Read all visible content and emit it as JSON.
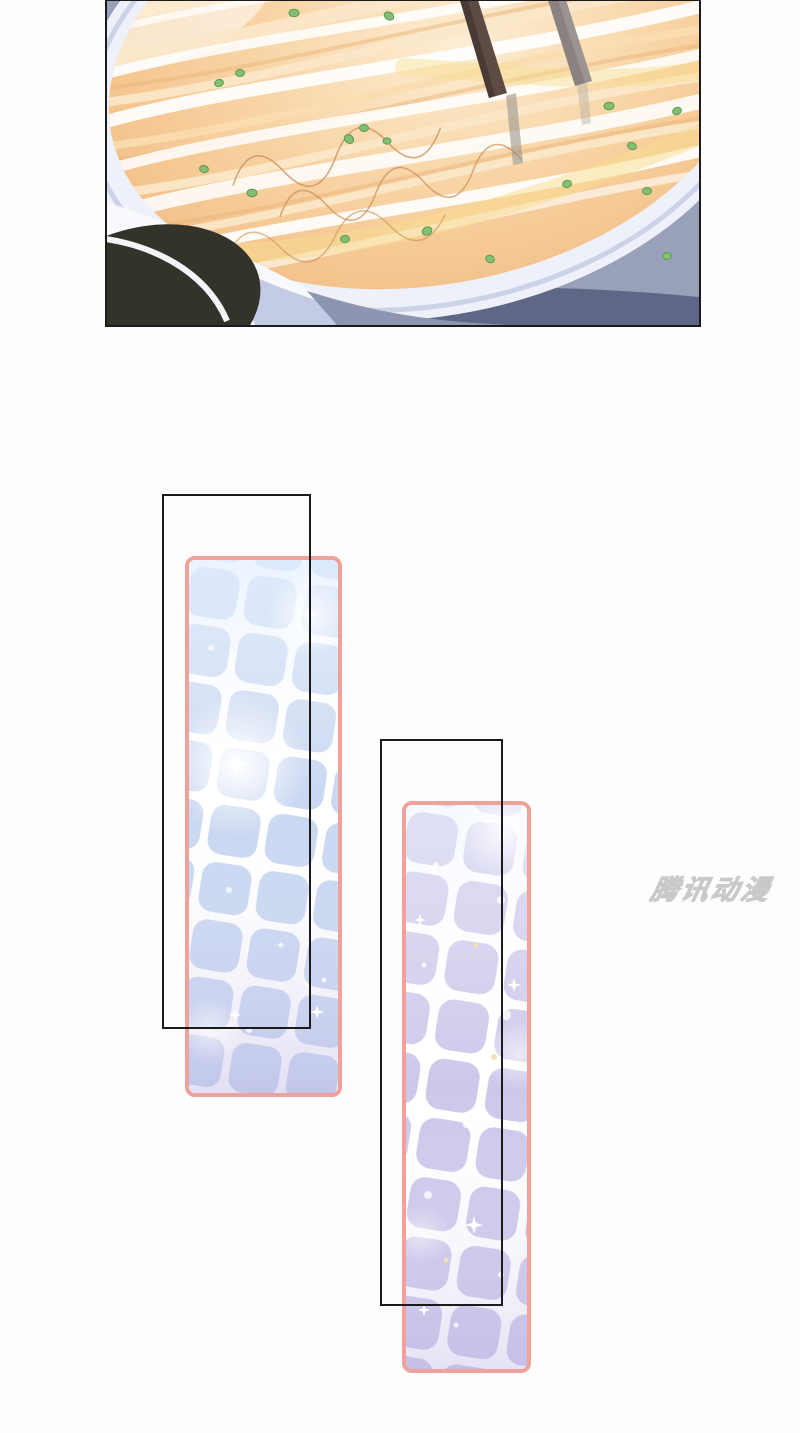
{
  "watermark": {
    "text": "腾讯动漫"
  },
  "palette": {
    "page_white": "#fdfdfd",
    "panel_border": "#1b1b1b",
    "frame_pink": "#efa29a",
    "tile_blue": "#c9d7f1",
    "tile_lavender": "#cdc8ea",
    "grout_white": "#ffffff",
    "kitchen_bg": "#99a1ba",
    "pan_rim": "#eef1f9",
    "noodles_orange": "#f6cf9e",
    "noodle_cream": "#fbe8ca",
    "glow_yellow": "#f7dd90",
    "garnish_green": "#82bf72",
    "chopstick_brown": "#5d4b44",
    "chopstick_gray": "#8a8280",
    "dark_bowl": "#34332a",
    "shadow_navy": "#4d5470",
    "stand_periwinkle": "#c3cce4",
    "watermark_gray": "#e2e2e2"
  }
}
